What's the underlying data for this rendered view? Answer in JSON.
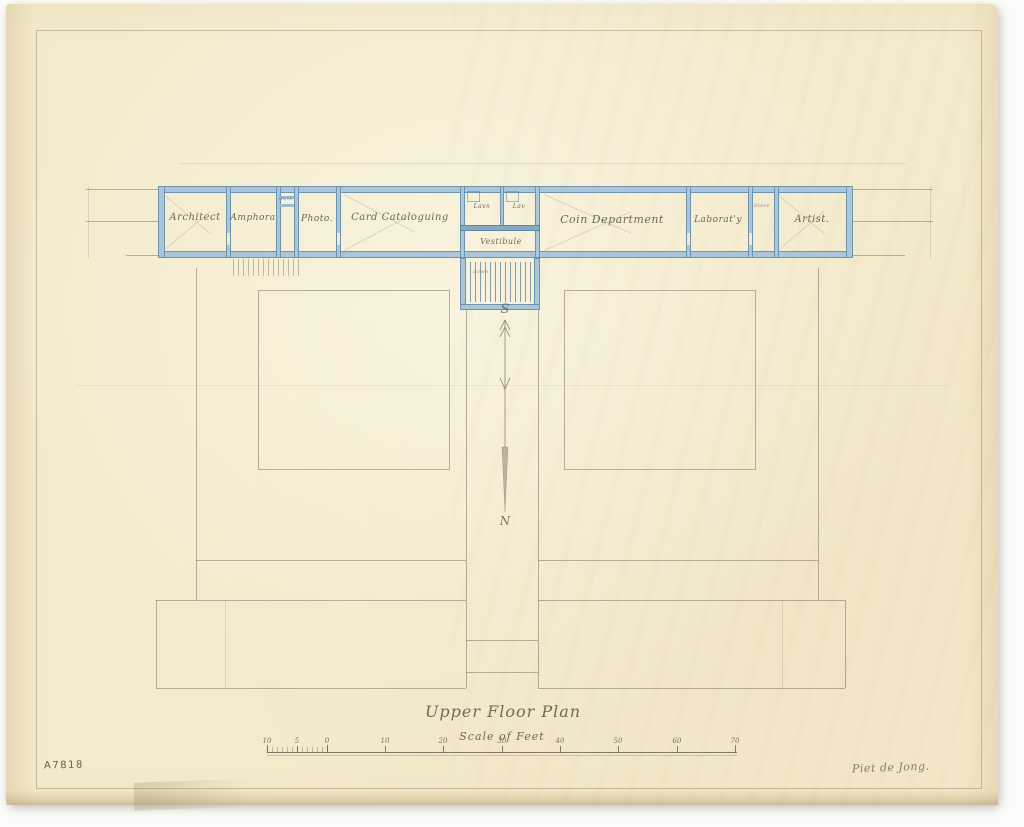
{
  "document": {
    "title": "Upper Floor Plan",
    "scale_label": "Scale of Feet",
    "catalog_number": "A7818",
    "signature": "Piet de Jong.",
    "medium": "pencil and blue ink floor-plan drawing on aged paper"
  },
  "palette": {
    "paper": "#f3eacb",
    "ink_blue": "#6d93ad",
    "ink_blue_fill": "#a9c6da",
    "pencil": "#766b5a"
  },
  "compass": {
    "south_label": "S",
    "north_label": "N"
  },
  "rooms": [
    {
      "id": "architect",
      "label": "Architect"
    },
    {
      "id": "amphora",
      "label": "Amphora"
    },
    {
      "id": "dark-room",
      "label": "dark"
    },
    {
      "id": "photo",
      "label": "Photo."
    },
    {
      "id": "card-cataloguing",
      "label": "Card Cataloguing"
    },
    {
      "id": "lavatory-1",
      "label": "Lavn"
    },
    {
      "id": "lavatory-2",
      "label": "Lav"
    },
    {
      "id": "vestibule",
      "label": "Vestibule"
    },
    {
      "id": "coin-department",
      "label": "Coin Department"
    },
    {
      "id": "laboratory",
      "label": "Laborat'y"
    },
    {
      "id": "store",
      "label": "Store"
    },
    {
      "id": "artist",
      "label": "Artist."
    }
  ],
  "stair": {
    "label": "down"
  },
  "scale_bar": {
    "unit": "feet",
    "tick_labels": [
      "10",
      "5",
      "0",
      "10",
      "20",
      "30",
      "40",
      "50",
      "60",
      "70"
    ]
  }
}
